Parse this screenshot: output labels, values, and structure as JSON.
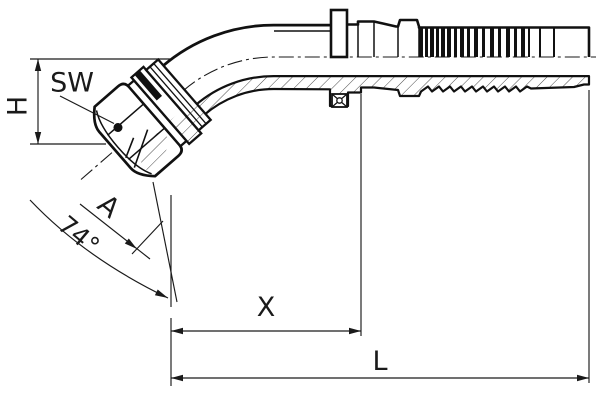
{
  "drawing": {
    "background": "#ffffff",
    "line_color": "#1a1a1a",
    "labels": {
      "wrench_size": "SW",
      "height": "H",
      "thread": "A",
      "cone_angle": "74°",
      "cutoff_length": "X",
      "overall_length": "L"
    }
  }
}
